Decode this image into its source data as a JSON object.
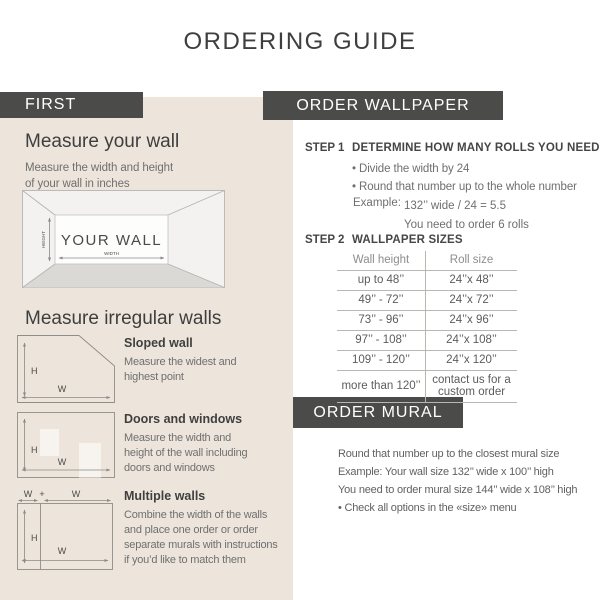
{
  "title": "ORDERING GUIDE",
  "colors": {
    "bar_background": "#4b4b49",
    "bar_text": "#ffffff",
    "panel_background": "#ede5dc",
    "heading_text": "#3e3e3e",
    "body_text": "#6f6f6f",
    "table_line": "#bab7b2",
    "floor_fill": "#dbd9d6"
  },
  "left": {
    "header": "FIRST",
    "measure_wall": {
      "heading": "Measure your wall",
      "subtitle_lines": [
        "Measure the width and height",
        "of your wall in inches"
      ],
      "diagram": {
        "wall_label": "YOUR WALL",
        "height_label": "HEIGHT",
        "width_label": "WIDTH"
      }
    },
    "irregular": {
      "heading": "Measure irregular walls",
      "items": [
        {
          "title": "Sloped wall",
          "lines": [
            "Measure the widest and",
            "highest point"
          ],
          "h": "H",
          "w": "W"
        },
        {
          "title": "Doors and windows",
          "lines": [
            "Measure the width and",
            "height of the wall including",
            "doors and windows"
          ],
          "h": "H",
          "w": "W"
        },
        {
          "title": "Multiple walls",
          "lines": [
            "Combine the width of the walls",
            "and place one order or order",
            "separate murals with instructions",
            "if you’d like to match them"
          ],
          "h": "H",
          "w": "W",
          "w1": "W",
          "plus": "+",
          "w2": "W"
        }
      ]
    }
  },
  "wallpaper": {
    "header": "ORDER WALLPAPER",
    "step1": {
      "label": "STEP 1",
      "title": "DETERMINE HOW MANY ROLLS YOU NEED",
      "bullets": [
        "• Divide the width by 24",
        "• Round that number up to the whole number"
      ],
      "example_label": "Example:",
      "example_line1": "132’’ wide / 24 = 5.5",
      "example_line2": "You need to order 6 rolls"
    },
    "step2": {
      "label": "STEP 2",
      "title": "WALLPAPER SIZES",
      "table": {
        "headers": [
          "Wall height",
          "Roll size"
        ],
        "rows": [
          {
            "wall_height": "up to 48’’",
            "roll_size": "24’’x 48’’"
          },
          {
            "wall_height": "49’’ - 72’’",
            "roll_size": "24’’x 72’’"
          },
          {
            "wall_height": "73’’ - 96’’",
            "roll_size": "24’’x 96’’"
          },
          {
            "wall_height": "97’’ - 108’’",
            "roll_size": "24’’x 108’’"
          },
          {
            "wall_height": "109’’ - 120’’",
            "roll_size": "24’’x 120’’"
          },
          {
            "wall_height": "more than 120’’",
            "roll_size": "contact us for a custom order"
          }
        ]
      }
    }
  },
  "mural": {
    "header": "ORDER MURAL",
    "lines": [
      "Round that number up to the closest mural size",
      "Example: Your wall size 132’’ wide x 100’’ high",
      "You need to order mural size 144’’ wide x 108’’ high",
      "• Check all options in the «size» menu"
    ]
  }
}
